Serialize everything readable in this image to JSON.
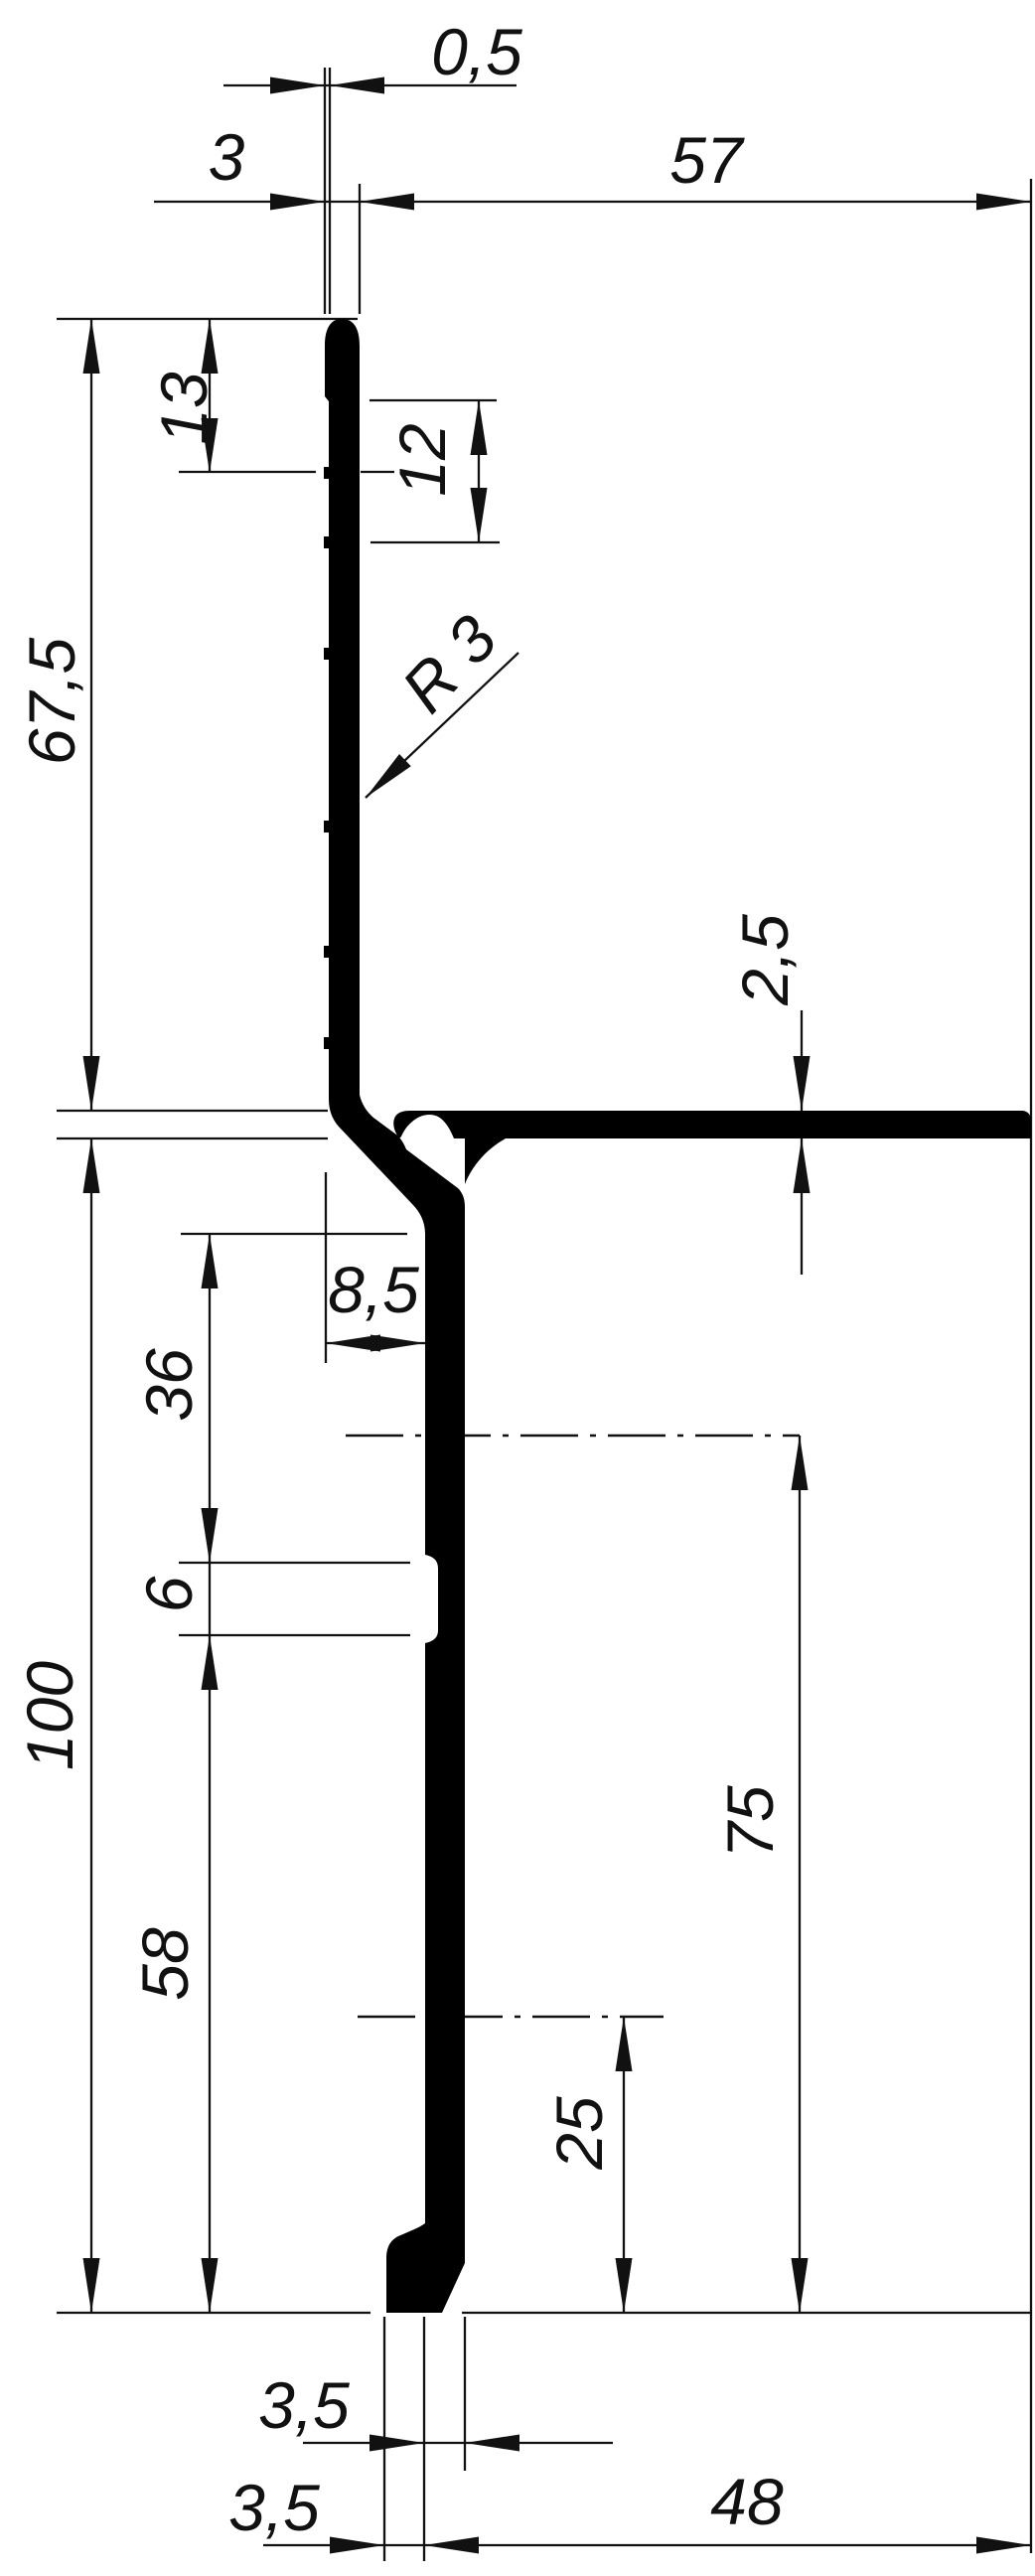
{
  "drawing": {
    "kind": "profile cross-section technical drawing",
    "dimensions": {
      "offset_05": "0,5",
      "wall_3": "3",
      "top_57": "57",
      "top_13": "13",
      "pitch_12": "12",
      "radius_r3": "R 3",
      "height_675": "67,5",
      "flange_25": "2,5",
      "offset_85": "8,5",
      "seg_36": "36",
      "notch_6": "6",
      "height_100": "100",
      "axis_75": "75",
      "seg_58": "58",
      "axis_25": "25",
      "stem_35": "3,5",
      "foot_35": "3,5",
      "bottom_48": "48"
    }
  }
}
